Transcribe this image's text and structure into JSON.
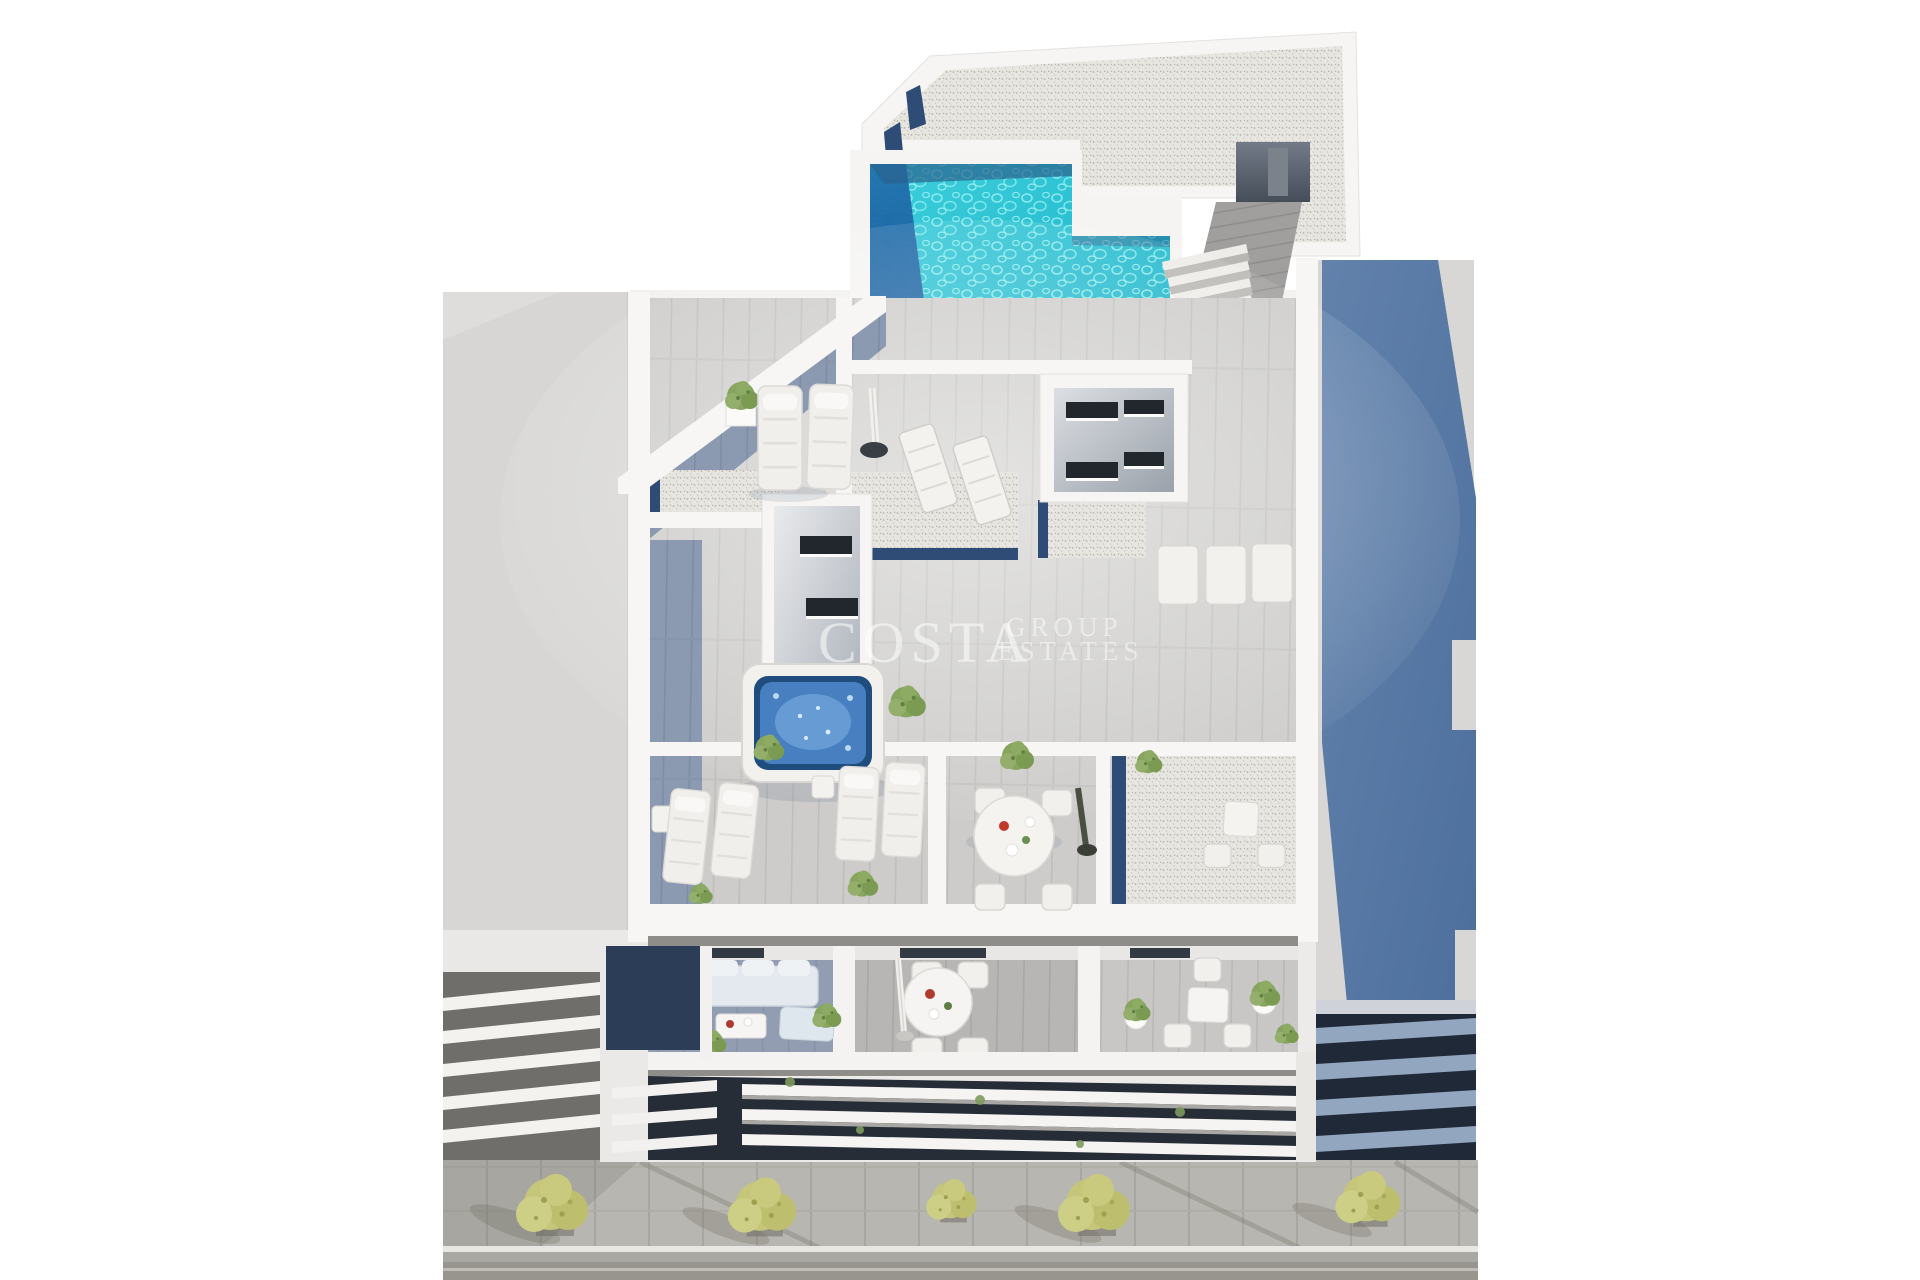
{
  "image": {
    "kind": "3D architectural exterior render, aerial view",
    "subject": "New-build apartment building rooftop solarium with swimming pool, private terraces, balconies and street frontage",
    "style": "white minimalist architecture, bright daylight, promotional real-estate visualization"
  },
  "watermark": {
    "primary": "COSTA",
    "secondary": "GROUP",
    "tertiary": "ESTATES"
  },
  "palette": {
    "background": "#ffffff",
    "pool_teal": "#2ec7d6",
    "pool_deep_blue": "#1e6faa",
    "cast_shadow_blue": "#5b79a4",
    "deck_sunlit": "#cdccca",
    "deck_shaded": "#8b99b1",
    "gravel": "#e7e5e0",
    "navy_glass_accent": "#2e4c76",
    "jacuzzi_blue": "#477fc0",
    "tree_green": "#c5c67a",
    "neighbor_gray": "#d7d6d4",
    "road_gray": "#97958e",
    "dark_glazing": "#262d36",
    "white_walls": "#f5f4f2",
    "sofa_upholstery": "#e3e9ee"
  },
  "scene": {
    "environment": [
      "white studio backdrop",
      "plain gray neighbor building on the left",
      "gray neighbor surface on the right with large blue cast shadow",
      "louvered facades at street level",
      "sidewalk with pavers, curb, gutter and asphalt road",
      "street trees with yellow-green foliage and cast shadows"
    ],
    "rooftop": [
      "speckled gravel flat roof",
      "L-shaped turquoise pool with dark deep end and water caustics",
      "dark entry mat",
      "external stair",
      "timber access walkway",
      "roof stair alcove"
    ],
    "solarium": [
      "gray timber decking with shaded blue-gray corner",
      "two padded sun loungers",
      "closed white parasol",
      "two folding loungers",
      "row of sunbeds",
      "stairwell skylight boxes with dark slot windows",
      "gravel borders with navy glass strips",
      "square hot tub with blue water",
      "potted shrubs"
    ],
    "lower_terraces": [
      "terraces divided by white walls",
      "paired sun loungers with side tables",
      "round dining table with four chairs",
      "closed dark parasol",
      "gravel court with bistro set"
    ],
    "balconies": [
      "lounge sofa set with coffee table and chaise",
      "round dining table with chairs and closed white parasol",
      "square side table with potted plants"
    ],
    "facade": [
      "three long white balcony slabs over dark glazing",
      "angled white fins at the corner",
      "hanging greenery tufts"
    ]
  }
}
